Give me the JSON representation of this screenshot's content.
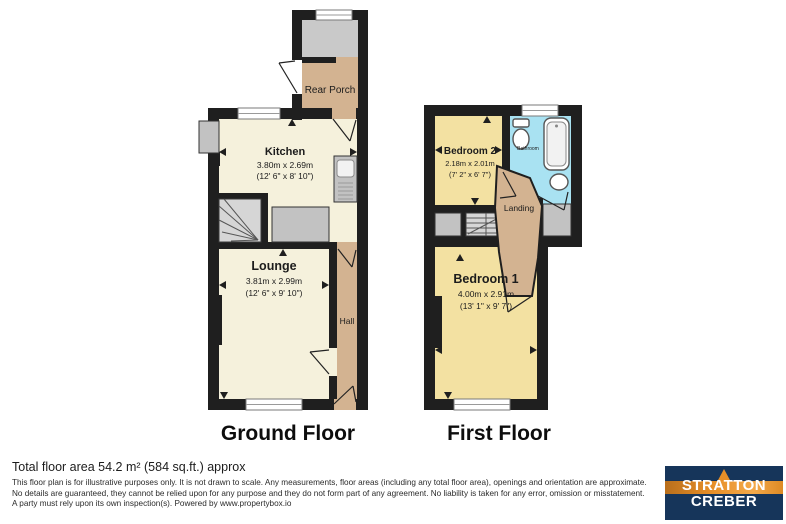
{
  "floors": {
    "ground": {
      "label": "Ground Floor"
    },
    "first": {
      "label": "First Floor"
    }
  },
  "rooms": {
    "rear_porch": {
      "name": "Rear Porch"
    },
    "kitchen": {
      "name": "Kitchen",
      "metric": "3.80m x 2.69m",
      "imperial": "(12' 6\" x 8' 10\")"
    },
    "lounge": {
      "name": "Lounge",
      "metric": "3.81m x 2.99m",
      "imperial": "(12' 6\" x 9' 10\")"
    },
    "hall": {
      "name": "Hall"
    },
    "bedroom2": {
      "name": "Bedroom 2",
      "metric": "2.18m x 2.01m",
      "imperial": "(7' 2\" x 6' 7\")"
    },
    "bathroom": {
      "name": "Bathroom"
    },
    "landing": {
      "name": "Landing"
    },
    "bedroom1": {
      "name": "Bedroom 1",
      "metric": "4.00m x 2.91m",
      "imperial": "(13' 1\" x 9' 7\")"
    }
  },
  "footer": {
    "total_area": "Total floor area 54.2 m² (584 sq.ft.) approx",
    "disclaimer": "This floor plan is for illustrative purposes only. It is not drawn to scale. Any measurements, floor areas (including any total floor area), openings and orientation are approximate. No details are guaranteed, they cannot be relied upon for any purpose and they do not form part of any agreement. No liability is taken for any error, omission or misstatement. A party must rely upon its own inspection(s). Powered by www.propertybox.io"
  },
  "logo": {
    "line1": "STRATTON",
    "line2": "CREBER"
  },
  "colors": {
    "wall": "#1f1f1f",
    "room-cream": "#f5f1dc",
    "room-tan": "#d3b391",
    "room-yellow": "#f3e1a2",
    "room-blue": "#a9e2f2",
    "fixture-gray": "#c2c2c2",
    "stair-gray": "#d6d6d6",
    "logo-navy": "#16355a",
    "logo-orange": "#e78f28"
  }
}
